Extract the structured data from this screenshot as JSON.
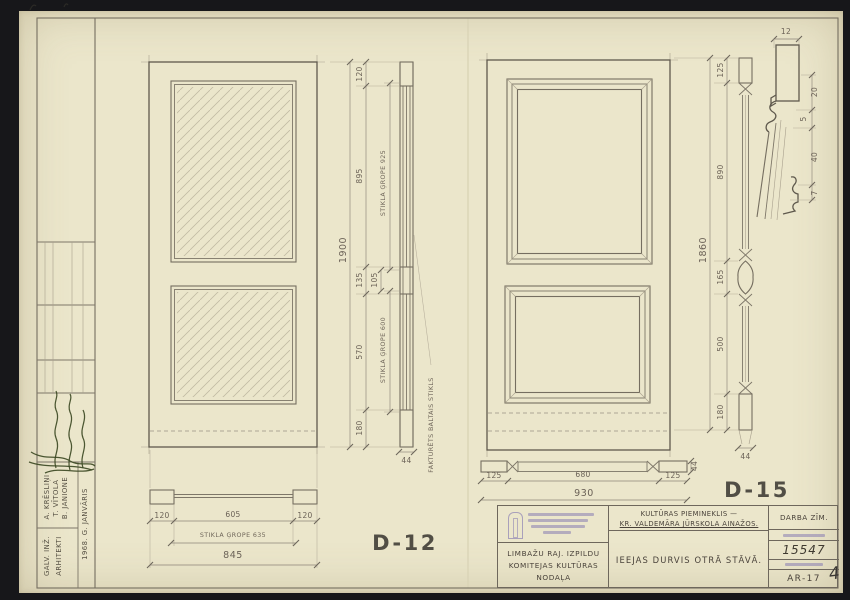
{
  "colors": {
    "paper": "#ebe6cb",
    "border_dark": "#17171a",
    "pencil": "#6e675c",
    "ink_dark": "#49423a",
    "stamp_blue": "#7d72b0",
    "signature_green": "#3d4a24"
  },
  "sheet": {
    "page_mark": "4"
  },
  "sidebar": {
    "role_1": "GALV. INŽ.",
    "role_2": "ARHITEKTI",
    "name_1": "A. KRĒSLIŅI",
    "name_2": "T. VĪTOLA",
    "name_3": "B. JANIONE",
    "date": "1968. G. JANVĀRIS"
  },
  "d12": {
    "label": "D-12",
    "glass_note": "FAKTURĒTS BALTAIS STIKLS",
    "section": {
      "overall": "1900",
      "top_rail": "120",
      "glass": "895",
      "groove_top": "STIKLA ĢROPE 925",
      "mid_rail": "135",
      "mid_sub": "105",
      "panel": "570",
      "groove_bottom": "STIKLA ĢROPE 600",
      "bottom_rail": "180",
      "thickness": "44"
    },
    "plan": {
      "stile_left": "120",
      "glass_width": "605",
      "stile_right": "120",
      "groove": "STIKLA ĢROPE 635",
      "overall": "845"
    }
  },
  "d15": {
    "label": "D-15",
    "section": {
      "overall": "1860",
      "top_rail": "125",
      "panel_top": "890",
      "mid_rail": "165",
      "panel_bottom": "500",
      "bottom_rail": "180",
      "thickness": "44"
    },
    "plan": {
      "stile_left": "125",
      "panel_width": "680",
      "stile_right": "125",
      "overall": "930",
      "thickness": "44"
    }
  },
  "detail": {
    "dim_width": "12",
    "dim_a": "20",
    "dim_b": "5",
    "dim_c": "40",
    "dim_d": "7"
  },
  "title_block": {
    "org_line_1": "LIMBAŽU RAJ. IZPILDU",
    "org_line_2": "KOMITEJAS KULTŪRAS",
    "org_line_3": "NODAĻA",
    "project_line_1": "KULTŪRAS PIEMINEKLIS —",
    "project_line_2": "KR. VALDEMĀRA JŪRSKOLA AINAŽOS.",
    "drawing_title": "IEEJAS DURVIS OTRĀ STĀVĀ.",
    "doc_type": "DARBA ZĪM.",
    "order_no": "15547",
    "sheet_no": "AR-17"
  }
}
